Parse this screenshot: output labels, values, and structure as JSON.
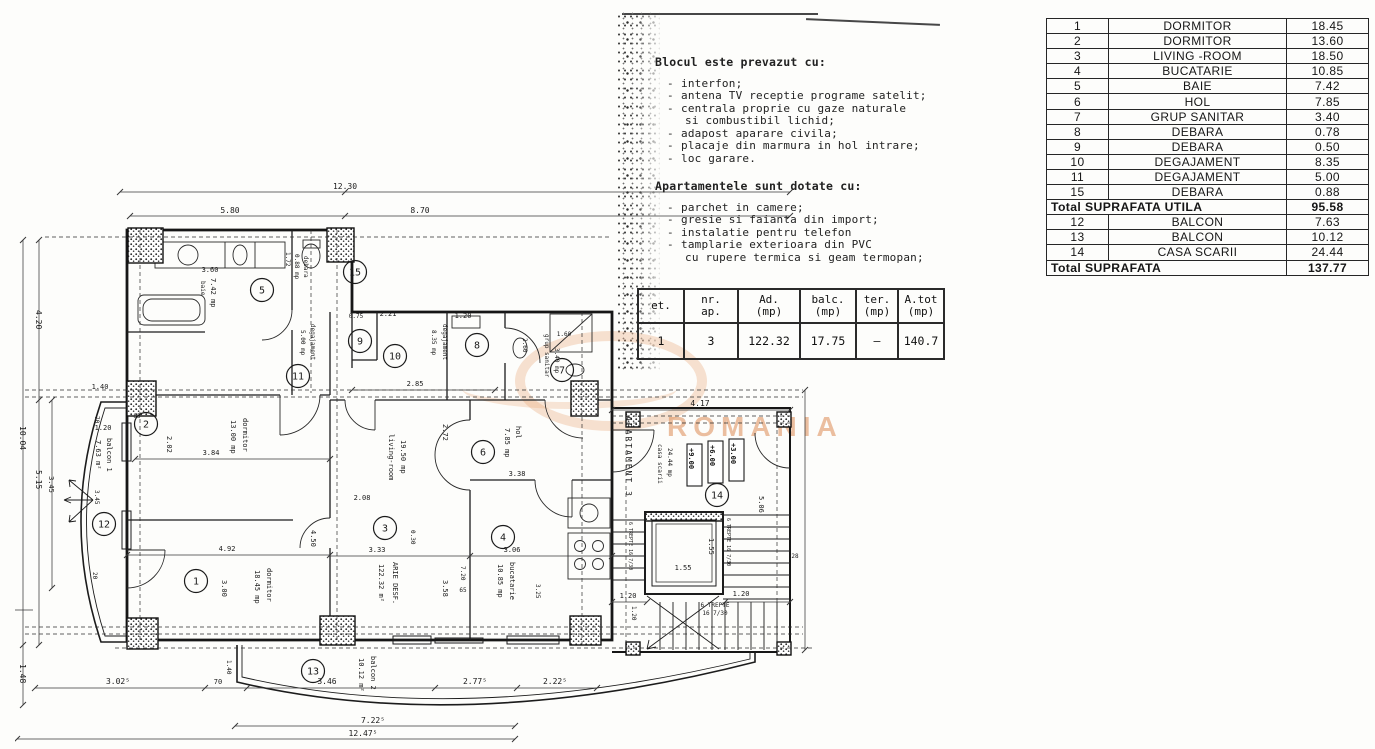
{
  "watermark": {
    "text": "ROMANIA",
    "color": "#dd8b54"
  },
  "notes": {
    "block_title": "Blocul este prevazut cu:",
    "block_items": [
      {
        "d": 1,
        "t": "interfon;"
      },
      {
        "d": 1,
        "t": "antena TV receptie programe satelit;"
      },
      {
        "d": 1,
        "t": "centrala proprie cu gaze naturale"
      },
      {
        "d": 0,
        "t": "si combustibil lichid;"
      },
      {
        "d": 1,
        "t": "adapost aparare civila;"
      },
      {
        "d": 1,
        "t": "placaje din marmura in hol intrare;"
      },
      {
        "d": 1,
        "t": "loc garare."
      }
    ],
    "apart_title": "Apartamentele sunt dotate cu:",
    "apart_items": [
      {
        "d": 1,
        "t": "parchet in camere;"
      },
      {
        "d": 1,
        "t": "gresie si faianta din import;"
      },
      {
        "d": 1,
        "t": "instalatie pentru telefon"
      },
      {
        "d": 1,
        "t": "tamplarie exterioara din PVC"
      },
      {
        "d": 0,
        "t": "cu rupere termica si geam termopan;"
      }
    ]
  },
  "summary_table": {
    "headers": [
      {
        "a": "et.",
        "b": ""
      },
      {
        "a": "nr.",
        "b": "ap."
      },
      {
        "a": "Ad.",
        "b": "(mp)"
      },
      {
        "a": "balc.",
        "b": "(mp)"
      },
      {
        "a": "ter.",
        "b": "(mp)"
      },
      {
        "a": "A.tot",
        "b": "(mp)"
      }
    ],
    "row": [
      "1",
      "3",
      "122.32",
      "17.75",
      "–",
      "140.7"
    ]
  },
  "room_table": {
    "rows": [
      {
        "no": "1",
        "name": "DORMITOR",
        "area": "18.45"
      },
      {
        "no": "2",
        "name": "DORMITOR",
        "area": "13.60"
      },
      {
        "no": "3",
        "name": "LIVING -ROOM",
        "area": "18.50"
      },
      {
        "no": "4",
        "name": "BUCATARIE",
        "area": "10.85"
      },
      {
        "no": "5",
        "name": "BAIE",
        "area": "7.42"
      },
      {
        "no": "6",
        "name": "HOL",
        "area": "7.85"
      },
      {
        "no": "7",
        "name": "GRUP SANITAR",
        "area": "3.40"
      },
      {
        "no": "8",
        "name": "DEBARA",
        "area": "0.78"
      },
      {
        "no": "9",
        "name": "DEBARA",
        "area": "0.50"
      },
      {
        "no": "10",
        "name": "DEGAJAMENT",
        "area": "8.35"
      },
      {
        "no": "11",
        "name": "DEGAJAMENT",
        "area": "5.00"
      },
      {
        "no": "15",
        "name": "DEBARA",
        "area": "0.88"
      },
      {
        "total": "Total SUPRAFATA UTILA",
        "area": "95.58"
      },
      {
        "no": "12",
        "name": "BALCON",
        "area": "7.63"
      },
      {
        "no": "13",
        "name": "BALCON",
        "area": "10.12"
      },
      {
        "no": "14",
        "name": "CASA SCARII",
        "area": "24.44"
      },
      {
        "total": "Total SUPRAFATA",
        "area": "137.77"
      }
    ]
  },
  "plan": {
    "circles": [
      {
        "n": "1",
        "x": 181,
        "y": 403
      },
      {
        "n": "2",
        "x": 131,
        "y": 246
      },
      {
        "n": "3",
        "x": 370,
        "y": 350
      },
      {
        "n": "4",
        "x": 488,
        "y": 359
      },
      {
        "n": "5",
        "x": 247,
        "y": 112
      },
      {
        "n": "6",
        "x": 468,
        "y": 274
      },
      {
        "n": "7",
        "x": 547,
        "y": 192
      },
      {
        "n": "8",
        "x": 462,
        "y": 167
      },
      {
        "n": "9",
        "x": 345,
        "y": 163
      },
      {
        "n": "10",
        "x": 380,
        "y": 178
      },
      {
        "n": "11",
        "x": 283,
        "y": 198
      },
      {
        "n": "12",
        "x": 89,
        "y": 346
      },
      {
        "n": "13",
        "x": 298,
        "y": 493
      },
      {
        "n": "14",
        "x": 702,
        "y": 317
      },
      {
        "n": "15",
        "x": 340,
        "y": 94
      }
    ],
    "texts": [
      {
        "t": "12.30",
        "x": 330,
        "y": 11,
        "s": 8
      },
      {
        "t": "5.80",
        "x": 215,
        "y": 35,
        "s": 8
      },
      {
        "t": "8.70",
        "x": 405,
        "y": 35,
        "s": 8
      },
      {
        "t": "3.60",
        "x": 195,
        "y": 94,
        "s": 7
      },
      {
        "t": "2.85",
        "x": 400,
        "y": 208,
        "s": 7
      },
      {
        "t": "2.21",
        "x": 373,
        "y": 138,
        "s": 7
      },
      {
        "t": "0.75",
        "x": 341,
        "y": 140,
        "s": 6
      },
      {
        "t": "1.20",
        "x": 448,
        "y": 140,
        "s": 7
      },
      {
        "t": "1.20",
        "x": 88,
        "y": 252,
        "s": 7
      },
      {
        "t": "1.40",
        "x": 85,
        "y": 211,
        "s": 7
      },
      {
        "t": "85",
        "x": 122,
        "y": 240,
        "s": 6
      },
      {
        "t": "3.84",
        "x": 196,
        "y": 277,
        "s": 7
      },
      {
        "t": "4.92",
        "x": 212,
        "y": 373,
        "s": 7
      },
      {
        "t": "2.08",
        "x": 347,
        "y": 322,
        "s": 7
      },
      {
        "t": "3.33",
        "x": 362,
        "y": 374,
        "s": 7
      },
      {
        "t": "3.06",
        "x": 497,
        "y": 374,
        "s": 7
      },
      {
        "t": "3.38",
        "x": 502,
        "y": 298,
        "s": 7
      },
      {
        "t": "65",
        "x": 448,
        "y": 414,
        "s": 6
      },
      {
        "t": "4.17",
        "x": 685,
        "y": 228,
        "s": 8
      },
      {
        "t": "1.20",
        "x": 613,
        "y": 420,
        "s": 7
      },
      {
        "t": "1.20",
        "x": 726,
        "y": 418,
        "s": 7
      },
      {
        "t": "1.55",
        "x": 668,
        "y": 392,
        "s": 7
      },
      {
        "t": "6 TREPTE",
        "x": 700,
        "y": 429,
        "s": 6
      },
      {
        "t": "16 7/30",
        "x": 700,
        "y": 437,
        "s": 6
      },
      {
        "t": "1.60",
        "x": 549,
        "y": 158,
        "s": 6
      },
      {
        "t": "28",
        "x": 780,
        "y": 380,
        "s": 6
      },
      {
        "t": "3.02⁵",
        "x": 103,
        "y": 506,
        "s": 8
      },
      {
        "t": "70",
        "x": 203,
        "y": 506,
        "s": 7
      },
      {
        "t": "3.46",
        "x": 312,
        "y": 506,
        "s": 8
      },
      {
        "t": "2.77⁵",
        "x": 460,
        "y": 506,
        "s": 8
      },
      {
        "t": "2.22⁵",
        "x": 540,
        "y": 506,
        "s": 8
      },
      {
        "t": "7.22⁵",
        "x": 358,
        "y": 545,
        "s": 8
      },
      {
        "t": "12.47⁵",
        "x": 348,
        "y": 558,
        "s": 8
      },
      {
        "t": "baie",
        "x": 186,
        "y": 103,
        "r": 90,
        "s": 6
      },
      {
        "t": "7.42 mp",
        "x": 196,
        "y": 100,
        "r": 90,
        "s": 7
      },
      {
        "t": "13.00 mp",
        "x": 216,
        "y": 242,
        "r": 90,
        "s": 7
      },
      {
        "t": "dormitor",
        "x": 228,
        "y": 240,
        "r": 90,
        "s": 7
      },
      {
        "t": "18.45 mp",
        "x": 240,
        "y": 392,
        "r": 90,
        "s": 7
      },
      {
        "t": "dormitor",
        "x": 252,
        "y": 390,
        "r": 90,
        "s": 7
      },
      {
        "t": "living-room",
        "x": 374,
        "y": 256,
        "r": 90,
        "s": 7
      },
      {
        "t": "19.50 mp",
        "x": 386,
        "y": 262,
        "r": 90,
        "s": 7
      },
      {
        "t": "122.32 m²",
        "x": 364,
        "y": 386,
        "r": 90,
        "s": 7
      },
      {
        "t": "ARIE DESF.",
        "x": 378,
        "y": 384,
        "r": 90,
        "s": 7
      },
      {
        "t": "hol",
        "x": 501,
        "y": 248,
        "r": 90,
        "s": 7
      },
      {
        "t": "7.85 mp",
        "x": 490,
        "y": 250,
        "r": 90,
        "s": 7
      },
      {
        "t": "10.85 mp",
        "x": 483,
        "y": 386,
        "r": 90,
        "s": 7
      },
      {
        "t": "bucatarie",
        "x": 495,
        "y": 384,
        "r": 90,
        "s": 7
      },
      {
        "t": "5.00 mp",
        "x": 286,
        "y": 152,
        "r": 90,
        "s": 6
      },
      {
        "t": "degajament",
        "x": 296,
        "y": 146,
        "r": 90,
        "s": 6
      },
      {
        "t": "8.35 mp",
        "x": 417,
        "y": 152,
        "r": 90,
        "s": 6
      },
      {
        "t": "degajament",
        "x": 428,
        "y": 146,
        "r": 90,
        "s": 6
      },
      {
        "t": "3.40 mp",
        "x": 540,
        "y": 170,
        "r": 90,
        "s": 6
      },
      {
        "t": "grup sanitar",
        "x": 530,
        "y": 156,
        "r": 90,
        "s": 6
      },
      {
        "t": "1.72",
        "x": 271,
        "y": 74,
        "r": 90,
        "s": 6
      },
      {
        "t": "0.88 mp",
        "x": 280,
        "y": 76,
        "r": 90,
        "s": 6
      },
      {
        "t": "debara",
        "x": 289,
        "y": 78,
        "r": 90,
        "s": 6
      },
      {
        "t": "7.63 m²",
        "x": 81,
        "y": 262,
        "r": 90,
        "s": 7
      },
      {
        "t": "balcon 1",
        "x": 92,
        "y": 260,
        "r": 90,
        "s": 7
      },
      {
        "t": "3.45",
        "x": 80,
        "y": 312,
        "r": 90,
        "s": 6
      },
      {
        "t": "10.12 m²",
        "x": 344,
        "y": 480,
        "r": 90,
        "s": 7
      },
      {
        "t": "balcon 2",
        "x": 356,
        "y": 478,
        "r": 90,
        "s": 7
      },
      {
        "t": "1.40",
        "x": 212,
        "y": 482,
        "r": 90,
        "s": 6
      },
      {
        "t": "2.02",
        "x": 152,
        "y": 258,
        "r": 90,
        "s": 7
      },
      {
        "t": "3.00",
        "x": 207,
        "y": 402,
        "r": 90,
        "s": 7
      },
      {
        "t": "0.30",
        "x": 396,
        "y": 352,
        "r": 90,
        "s": 6
      },
      {
        "t": "3.58",
        "x": 428,
        "y": 402,
        "r": 90,
        "s": 7
      },
      {
        "t": "7.20",
        "x": 446,
        "y": 388,
        "r": 90,
        "s": 6
      },
      {
        "t": "3.25",
        "x": 521,
        "y": 406,
        "r": 90,
        "s": 6
      },
      {
        "t": "2.72",
        "x": 428,
        "y": 246,
        "r": 90,
        "s": 7
      },
      {
        "t": "2.60",
        "x": 508,
        "y": 160,
        "r": 90,
        "s": 6
      },
      {
        "t": "4.50",
        "x": 296,
        "y": 352,
        "r": 90,
        "s": 7
      },
      {
        "t": "APARTAMENT 3",
        "x": 611,
        "y": 238,
        "r": 90,
        "s": 8,
        "ls": 2
      },
      {
        "t": "casa scarii",
        "x": 643,
        "y": 266,
        "r": 90,
        "s": 6
      },
      {
        "t": "24.44 mp",
        "x": 653,
        "y": 270,
        "r": 90,
        "s": 6
      },
      {
        "t": "+9.00",
        "x": 674,
        "y": 270,
        "r": 90,
        "s": 7,
        "b": 1
      },
      {
        "t": "+6.00",
        "x": 695,
        "y": 267,
        "r": 90,
        "s": 7,
        "b": 1
      },
      {
        "t": "+3.00",
        "x": 716,
        "y": 265,
        "r": 90,
        "s": 7,
        "b": 1
      },
      {
        "t": "1.55",
        "x": 694,
        "y": 360,
        "r": 90,
        "s": 7
      },
      {
        "t": "5.06",
        "x": 744,
        "y": 318,
        "r": 90,
        "s": 7
      },
      {
        "t": "1.20",
        "x": 617,
        "y": 428,
        "r": 90,
        "s": 6
      },
      {
        "t": "6 TREPTE 16 7/30",
        "x": 614,
        "y": 344,
        "r": 90,
        "s": 5
      },
      {
        "t": "6 TREPTE 16 7/30",
        "x": 712,
        "y": 340,
        "r": 90,
        "s": 5
      },
      {
        "t": "4.20",
        "x": 21,
        "y": 132,
        "r": 90,
        "s": 8
      },
      {
        "t": "10.04",
        "x": 5,
        "y": 248,
        "r": 90,
        "s": 8
      },
      {
        "t": "5.15",
        "x": 21,
        "y": 292,
        "r": 90,
        "s": 8
      },
      {
        "t": "3.45",
        "x": 34,
        "y": 298,
        "r": 90,
        "s": 7
      },
      {
        "t": "1.48",
        "x": 5,
        "y": 486,
        "r": 90,
        "s": 8
      },
      {
        "t": "70",
        "x": 80,
        "y": 238,
        "r": 90,
        "s": 6
      },
      {
        "t": "20",
        "x": 78,
        "y": 394,
        "r": 90,
        "s": 6
      }
    ]
  }
}
